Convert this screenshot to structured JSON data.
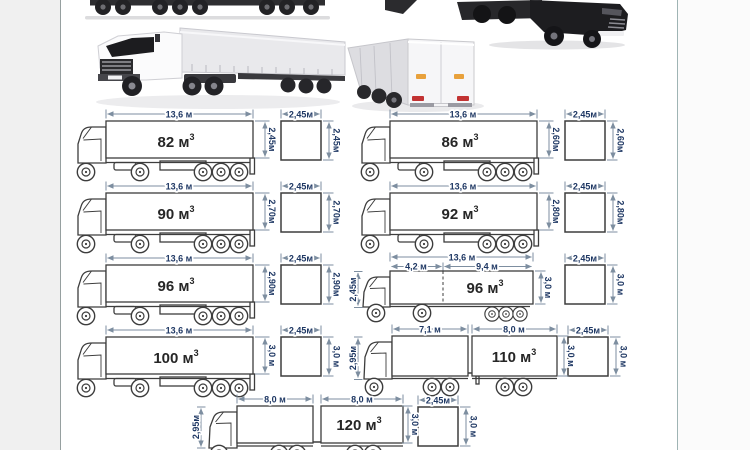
{
  "colors": {
    "dimension_label": "#1f3864",
    "volume_label": "#262626",
    "drawing_line": "#3d3d3d",
    "arrow_line": "#7d8ea0",
    "page_margin_left": "#f0f0f0",
    "page_margin_right": "#fbfbfb"
  },
  "photos": {
    "top_left": "truck-underside-photo",
    "top_right": "dark-tractor-photo",
    "mid_left": "white-semitrailer-truck-photo",
    "mid_right": "trailer-rear-view-photo"
  },
  "diagrams": [
    {
      "id": "semi-82",
      "type": "semitrailer",
      "length": "13,6 м",
      "height": "2,45м",
      "volume": {
        "base": "82 м",
        "sup": "3"
      },
      "cross_width": "2,45м",
      "cross_height": "2,45м"
    },
    {
      "id": "semi-86",
      "type": "semitrailer",
      "length": "13,6 м",
      "height": "2,60м",
      "volume": {
        "base": "86 м",
        "sup": "3"
      },
      "cross_width": "2,45м",
      "cross_height": "2,60м"
    },
    {
      "id": "semi-90",
      "type": "semitrailer",
      "length": "13,6 м",
      "height": "2,70м",
      "volume": {
        "base": "90 м",
        "sup": "3"
      },
      "cross_width": "2,45м",
      "cross_height": "2,70м"
    },
    {
      "id": "semi-92",
      "type": "semitrailer",
      "length": "13,6 м",
      "height": "2,80м",
      "volume": {
        "base": "92 м",
        "sup": "3"
      },
      "cross_width": "2,45м",
      "cross_height": "2,80м"
    },
    {
      "id": "semi-96",
      "type": "semitrailer",
      "length": "13,6 м",
      "height": "2,90м",
      "volume": {
        "base": "96 м",
        "sup": "3"
      },
      "cross_width": "2,45м",
      "cross_height": "2,90м"
    },
    {
      "id": "jumbo-96",
      "type": "jumbo",
      "length_total": "13,6 м",
      "length_front": "4,2 м",
      "length_rear": "9,4 м",
      "cab_height": "2,45м",
      "height": "3,0 м",
      "volume": {
        "base": "96 м",
        "sup": "3"
      },
      "cross_width": "2,45м",
      "cross_height": "3,0 м"
    },
    {
      "id": "semi-100",
      "type": "semitrailer",
      "length": "13,6 м",
      "height": "3,0 м",
      "volume": {
        "base": "100 м",
        "sup": "3"
      },
      "cross_width": "2,45м",
      "cross_height": "3,0 м"
    },
    {
      "id": "roadtrain-110",
      "type": "roadtrain",
      "length_front": "7,1 м",
      "length_rear": "8,0 м",
      "cab_height": "2,95м",
      "height": "3,0 м",
      "volume": {
        "base": "110 м",
        "sup": "3"
      },
      "cross_width": "2,45м",
      "cross_height": "3,0 м"
    },
    {
      "id": "roadtrain-120",
      "type": "roadtrain",
      "length_front": "8,0 м",
      "length_rear": "8,0 м",
      "cab_height": "2,95м",
      "height": "3,0 м",
      "volume": {
        "base": "120 м",
        "sup": "3"
      },
      "cross_width": "2,45м",
      "cross_height": "3,0 м"
    }
  ]
}
